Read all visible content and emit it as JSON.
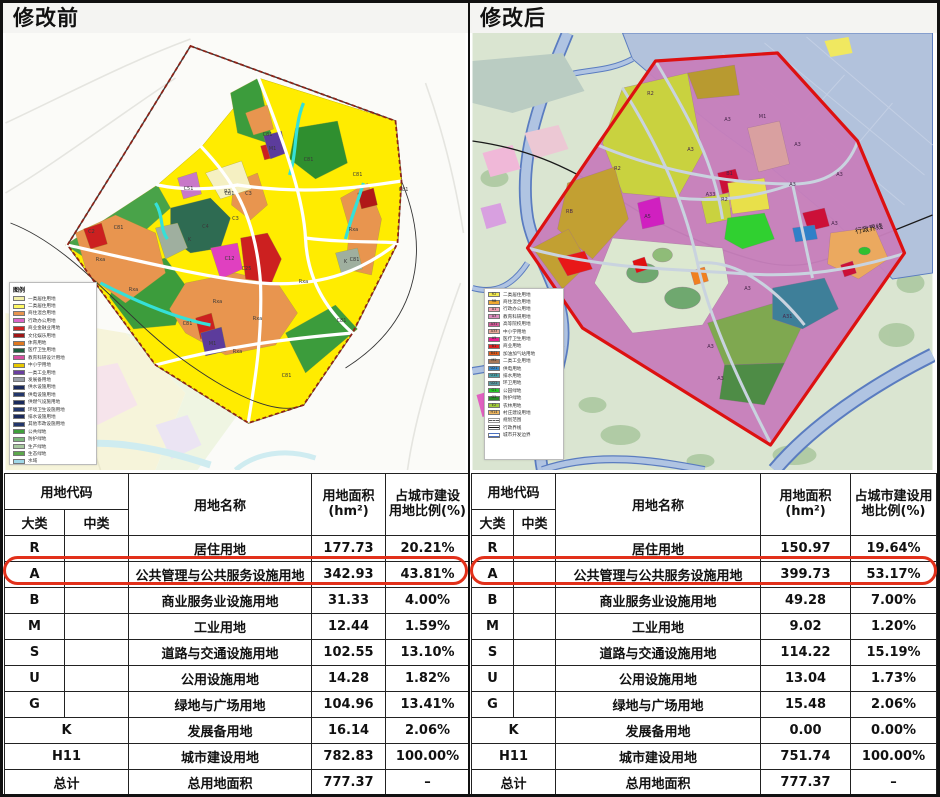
{
  "colors": {
    "highlight_red": "#E2301A",
    "plan_boundary_red": "#DD1111",
    "table_border": "#222222",
    "before_base_yellow": "#FFEC00",
    "after_base_magenta": "#C77FBB"
  },
  "left": {
    "title": "修改前",
    "map": {
      "legend_title": "图例",
      "legend": [
        {
          "color": "#F2EFA8",
          "label": "一类居住用地"
        },
        {
          "color": "#FFF966",
          "label": "二类居住用地"
        },
        {
          "color": "#E8954F",
          "label": "商住混合用地"
        },
        {
          "color": "#D966C8",
          "label": "行政办公用地"
        },
        {
          "color": "#CC2222",
          "label": "商业金融业用地"
        },
        {
          "color": "#A01515",
          "label": "文化娱乐用地"
        },
        {
          "color": "#E07820",
          "label": "体育用地"
        },
        {
          "color": "#1E5C3C",
          "label": "医疗卫生用地"
        },
        {
          "color": "#D64FA0",
          "label": "教育科研设计用地"
        },
        {
          "color": "#E8C800",
          "label": "中小学用地"
        },
        {
          "color": "#6A3FA0",
          "label": "一类工业用地"
        },
        {
          "color": "#9AA0A8",
          "label": "发展备用地"
        },
        {
          "color": "#1A2A5C",
          "label": "供水设施用地"
        },
        {
          "color": "#22366B",
          "label": "供电设施用地"
        },
        {
          "color": "#1A2A5C",
          "label": "供燃气设施用地"
        },
        {
          "color": "#22366B",
          "label": "环境卫生设施用地"
        },
        {
          "color": "#1A2A5C",
          "label": "排水设施用地"
        },
        {
          "color": "#22366B",
          "label": "其他市政设施用地"
        },
        {
          "color": "#3FA03C",
          "label": "公共绿地"
        },
        {
          "color": "#7CB87C",
          "label": "防护绿地"
        },
        {
          "color": "#A8C8A0",
          "label": "生产绿地"
        },
        {
          "color": "#5CA84C",
          "label": "生态绿地"
        },
        {
          "color": "#A0D8E8",
          "label": "水域"
        }
      ],
      "labels": [
        {
          "t": "C81",
          "x": 262,
          "y": 103
        },
        {
          "t": "C81",
          "x": 303,
          "y": 128
        },
        {
          "t": "C81",
          "x": 224,
          "y": 162
        },
        {
          "t": "C81",
          "x": 352,
          "y": 143
        },
        {
          "t": "C81",
          "x": 398,
          "y": 158
        },
        {
          "t": "C81",
          "x": 113,
          "y": 196
        },
        {
          "t": "C81",
          "x": 349,
          "y": 228
        },
        {
          "t": "C81",
          "x": 281,
          "y": 344
        },
        {
          "t": "C81",
          "x": 182,
          "y": 292
        },
        {
          "t": "C81",
          "x": 336,
          "y": 289
        },
        {
          "t": "Rxa",
          "x": 95,
          "y": 228
        },
        {
          "t": "Rxa",
          "x": 128,
          "y": 258
        },
        {
          "t": "Rxa",
          "x": 212,
          "y": 270
        },
        {
          "t": "Rxa",
          "x": 252,
          "y": 287
        },
        {
          "t": "Rxa",
          "x": 298,
          "y": 250
        },
        {
          "t": "Rxa",
          "x": 232,
          "y": 320
        },
        {
          "t": "Rxa",
          "x": 348,
          "y": 198
        },
        {
          "t": "M1",
          "x": 267,
          "y": 117
        },
        {
          "t": "M1",
          "x": 207,
          "y": 312
        },
        {
          "t": "C3",
          "x": 230,
          "y": 187
        },
        {
          "t": "C3",
          "x": 243,
          "y": 162
        },
        {
          "t": "C25",
          "x": 241,
          "y": 237
        },
        {
          "t": "C12",
          "x": 224,
          "y": 227
        },
        {
          "t": "C4",
          "x": 200,
          "y": 195
        },
        {
          "t": "K",
          "x": 184,
          "y": 208
        },
        {
          "t": "K",
          "x": 340,
          "y": 230
        },
        {
          "t": "R2",
          "x": 222,
          "y": 160
        },
        {
          "t": "C51",
          "x": 183,
          "y": 157
        },
        {
          "t": "C2",
          "x": 86,
          "y": 200
        }
      ]
    },
    "table": {
      "header": {
        "code": "用地代码",
        "major": "大类",
        "minor": "中类",
        "name": "用地名称",
        "area": "用地面积\n(hm²)",
        "ratio": "占城市建设\n用地比例(%)"
      },
      "rows": [
        {
          "major": "R",
          "minor": "",
          "name": "居住用地",
          "area": "177.73",
          "ratio": "20.21%"
        },
        {
          "major": "A",
          "minor": "",
          "name": "公共管理与公共服务设施用地",
          "area": "342.93",
          "ratio": "43.81%",
          "highlight": true
        },
        {
          "major": "B",
          "minor": "",
          "name": "商业服务业设施用地",
          "area": "31.33",
          "ratio": "4.00%"
        },
        {
          "major": "M",
          "minor": "",
          "name": "工业用地",
          "area": "12.44",
          "ratio": "1.59%"
        },
        {
          "major": "S",
          "minor": "",
          "name": "道路与交通设施用地",
          "area": "102.55",
          "ratio": "13.10%"
        },
        {
          "major": "U",
          "minor": "",
          "name": "公用设施用地",
          "area": "14.28",
          "ratio": "1.82%"
        },
        {
          "major": "G",
          "minor": "",
          "name": "绿地与广场用地",
          "area": "104.96",
          "ratio": "13.41%"
        },
        {
          "major": "K",
          "span": true,
          "name": "发展备用地",
          "area": "16.14",
          "ratio": "2.06%"
        },
        {
          "major": "H11",
          "span": true,
          "name": "城市建设用地",
          "area": "782.83",
          "ratio": "100.00%"
        },
        {
          "major": "总计",
          "span": true,
          "name": "总用地面积",
          "area": "777.37",
          "ratio": "–"
        }
      ]
    }
  },
  "right": {
    "title": "修改后",
    "map": {
      "boundary_label": "行政界线",
      "legend": [
        {
          "code": "R2",
          "color": "#F2E94E",
          "label": "二类居住用地"
        },
        {
          "code": "RB",
          "color": "#F0A830",
          "label": "商住混合用地"
        },
        {
          "code": "A1",
          "color": "#F2A0B4",
          "label": "行政办公用地"
        },
        {
          "code": "A3",
          "color": "#DE8CBE",
          "label": "教育科研用地"
        },
        {
          "code": "A31",
          "color": "#D45898",
          "label": "高等院校用地"
        },
        {
          "code": "A33",
          "color": "#E8A898",
          "label": "中小学用地"
        },
        {
          "code": "A5",
          "color": "#E82090",
          "label": "医疗卫生用地"
        },
        {
          "code": "B1",
          "color": "#E02020",
          "label": "商业用地"
        },
        {
          "code": "B41",
          "color": "#E05818",
          "label": "加油加气站用地"
        },
        {
          "code": "M2",
          "color": "#A87858",
          "label": "二类工业用地"
        },
        {
          "code": "U21",
          "color": "#3888C8",
          "label": "供电用地"
        },
        {
          "code": "U15",
          "color": "#48A0A8",
          "label": "排水用地"
        },
        {
          "code": "U22",
          "color": "#5898A0",
          "label": "环卫用地"
        },
        {
          "code": "G1",
          "color": "#28C828",
          "label": "公园绿地"
        },
        {
          "code": "G2",
          "color": "#288828",
          "label": "防护绿地"
        },
        {
          "code": "E2",
          "color": "#A0C838",
          "label": "农林用地"
        },
        {
          "code": "H14",
          "color": "#F0B860",
          "label": "村庄建设用地"
        },
        {
          "line": "dash",
          "label": "规划范围"
        },
        {
          "line": "solid",
          "label": "行政界线"
        },
        {
          "line": "double",
          "label": "城市开发边界"
        }
      ],
      "labels": [
        {
          "t": "A3",
          "x": 255,
          "y": 88
        },
        {
          "t": "A3",
          "x": 218,
          "y": 118
        },
        {
          "t": "A3",
          "x": 325,
          "y": 113
        },
        {
          "t": "A3",
          "x": 367,
          "y": 143
        },
        {
          "t": "A3",
          "x": 320,
          "y": 153
        },
        {
          "t": "A3",
          "x": 275,
          "y": 257
        },
        {
          "t": "A3",
          "x": 238,
          "y": 315
        },
        {
          "t": "A3",
          "x": 248,
          "y": 347
        },
        {
          "t": "A3",
          "x": 362,
          "y": 192
        },
        {
          "t": "R2",
          "x": 178,
          "y": 62
        },
        {
          "t": "R2",
          "x": 145,
          "y": 137
        },
        {
          "t": "R2",
          "x": 252,
          "y": 168
        },
        {
          "t": "M1",
          "x": 290,
          "y": 85
        },
        {
          "t": "B1",
          "x": 257,
          "y": 142
        },
        {
          "t": "A33",
          "x": 238,
          "y": 163
        },
        {
          "t": "A5",
          "x": 175,
          "y": 185
        },
        {
          "t": "A31",
          "x": 315,
          "y": 285
        },
        {
          "t": "RB",
          "x": 97,
          "y": 180
        }
      ]
    },
    "table": {
      "header": {
        "code": "用地代码",
        "major": "大类",
        "minor": "中类",
        "name": "用地名称",
        "area": "用地面积(hm²)",
        "ratio": "占城市建设用\n地比例(%)"
      },
      "rows": [
        {
          "major": "R",
          "minor": "",
          "name": "居住用地",
          "area": "150.97",
          "ratio": "19.64%"
        },
        {
          "major": "A",
          "minor": "",
          "name": "公共管理与公共服务设施用地",
          "area": "399.73",
          "ratio": "53.17%",
          "highlight": true
        },
        {
          "major": "B",
          "minor": "",
          "name": "商业服务业设施用地",
          "area": "49.28",
          "ratio": "7.00%"
        },
        {
          "major": "M",
          "minor": "",
          "name": "工业用地",
          "area": "9.02",
          "ratio": "1.20%"
        },
        {
          "major": "S",
          "minor": "",
          "name": "道路与交通设施用地",
          "area": "114.22",
          "ratio": "15.19%"
        },
        {
          "major": "U",
          "minor": "",
          "name": "公用设施用地",
          "area": "13.04",
          "ratio": "1.73%"
        },
        {
          "major": "G",
          "minor": "",
          "name": "绿地与广场用地",
          "area": "15.48",
          "ratio": "2.06%"
        },
        {
          "major": "K",
          "span": true,
          "name": "发展备用地",
          "area": "0.00",
          "ratio": "0.00%"
        },
        {
          "major": "H11",
          "span": true,
          "name": "城市建设用地",
          "area": "751.74",
          "ratio": "100.00%"
        },
        {
          "major": "总计",
          "span": true,
          "name": "总用地面积",
          "area": "777.37",
          "ratio": "–"
        }
      ]
    }
  }
}
